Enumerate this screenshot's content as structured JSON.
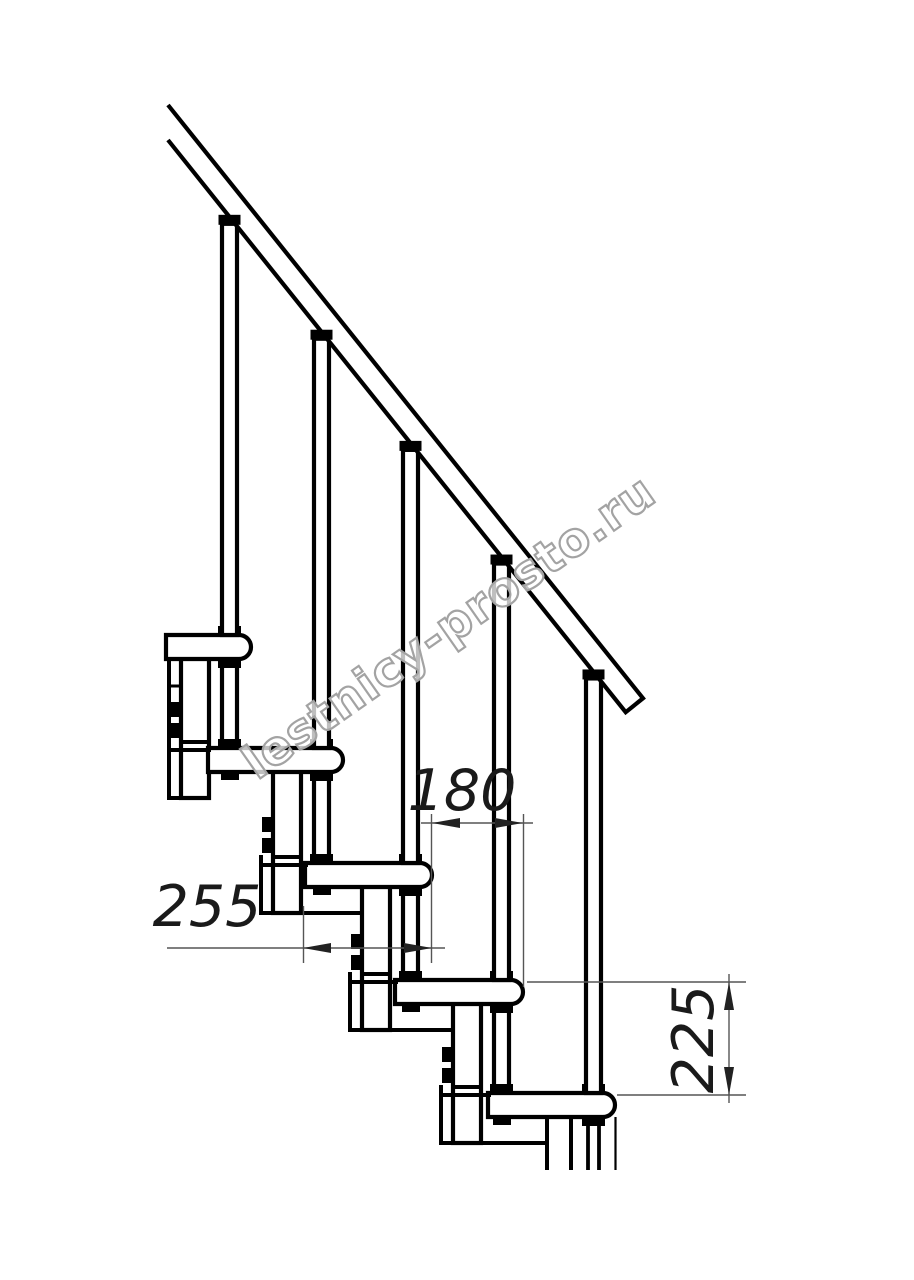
{
  "title": "Modular staircase side elevation drawing",
  "diagram": {
    "type": "technical-drawing",
    "subject": "modular staircase side view with handrail, balusters, treads and support columns",
    "dimensions": {
      "step_run": {
        "value": "180",
        "orientation": "horizontal"
      },
      "tread_depth": {
        "value": "255",
        "orientation": "horizontal"
      },
      "riser_height": {
        "value": "225",
        "orientation": "vertical"
      }
    },
    "watermark": {
      "text": "lestnicy-prosto.ru"
    },
    "colors": {
      "background": "#ffffff",
      "drawing_line": "#000000",
      "dimension_line": "#555555",
      "arrow": "#222222",
      "watermark_outline": "#a3a3a3"
    }
  }
}
